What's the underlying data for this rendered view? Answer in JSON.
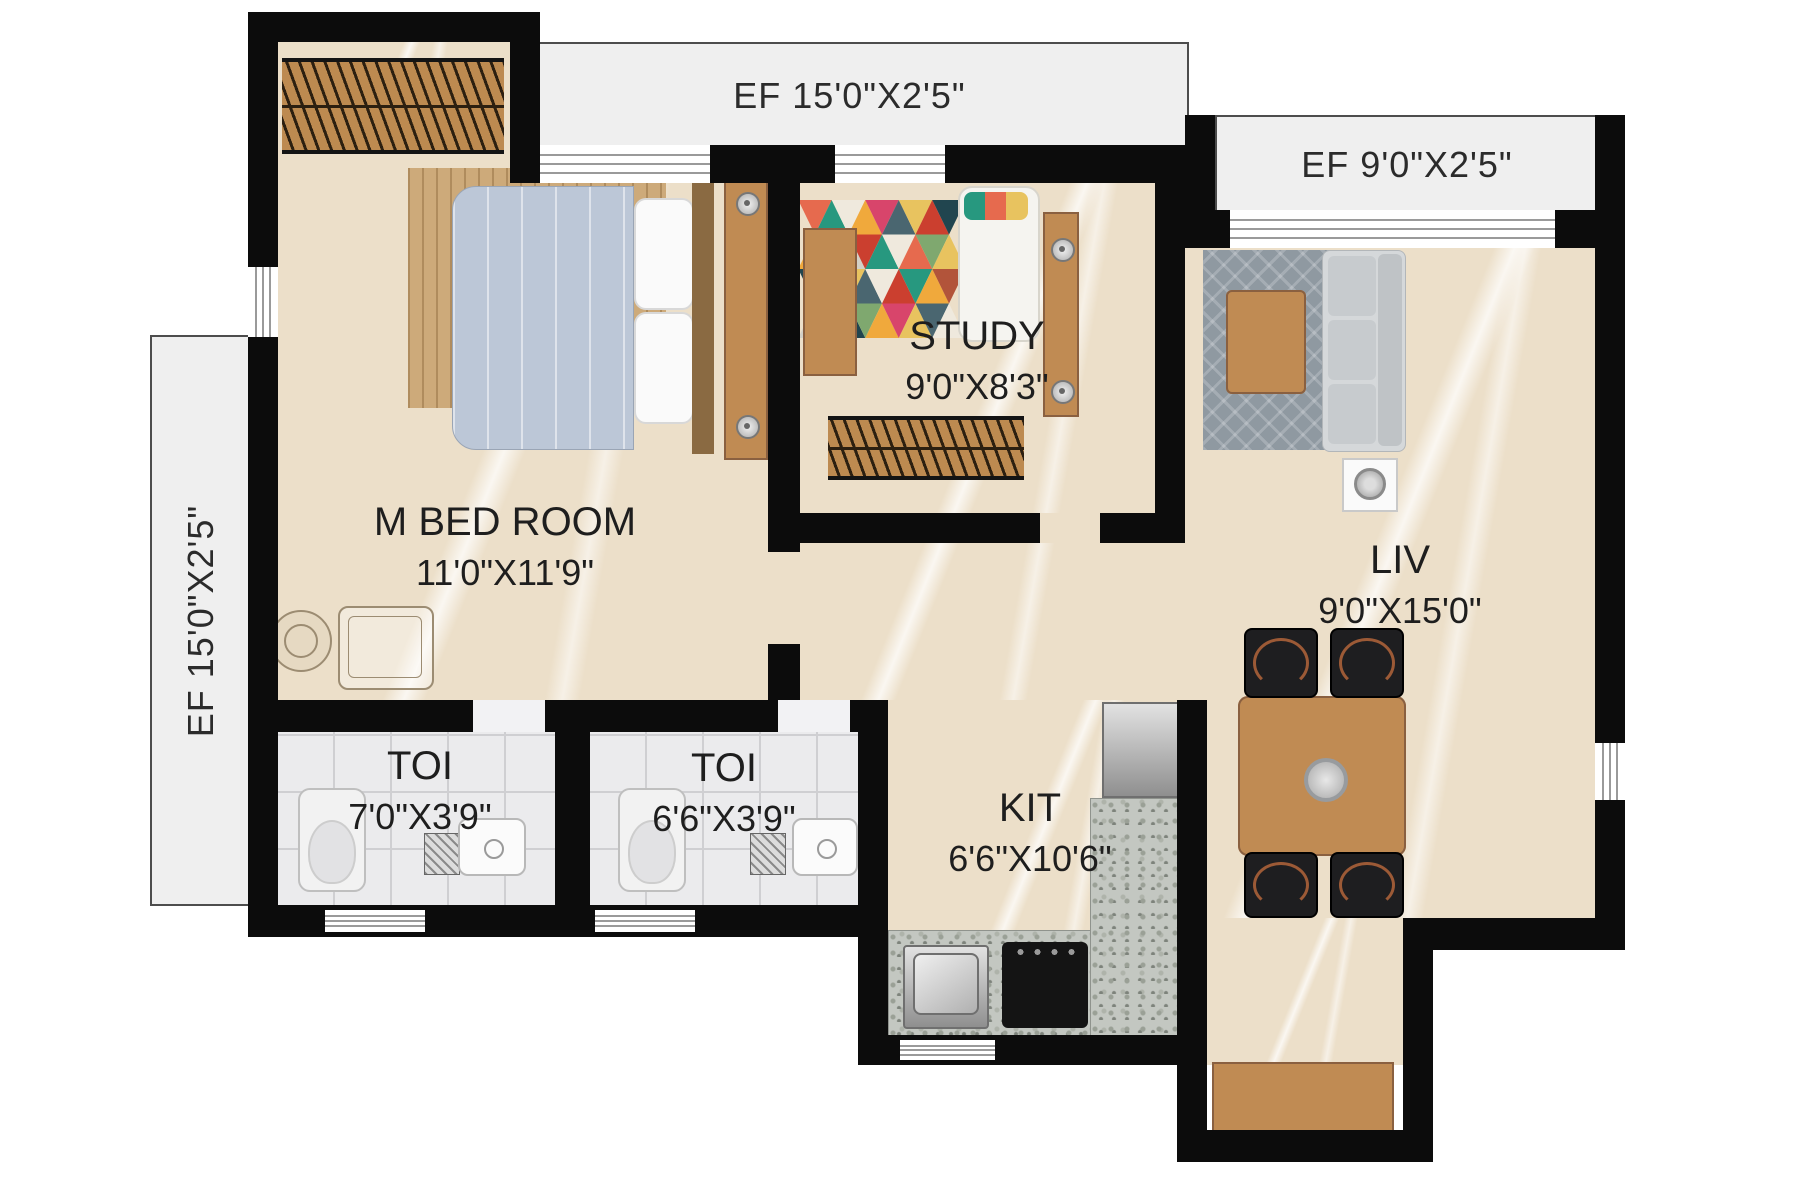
{
  "plan": {
    "title": "2BHK Floor Plan",
    "ef_top": "EF 15'0\"X2'5\"",
    "ef_right": "EF 9'0\"X2'5\"",
    "ef_left": "EF 15'0\"X2'5\"",
    "rooms": {
      "mbed": {
        "name": "M BED ROOM",
        "dim": "11'0\"X11'9\""
      },
      "study": {
        "name": "STUDY",
        "dim": "9'0\"X8'3\""
      },
      "liv": {
        "name": "LIV",
        "dim": "9'0\"X15'0\""
      },
      "toi1": {
        "name": "TOI",
        "dim": "7'0\"X3'9\""
      },
      "toi2": {
        "name": "TOI",
        "dim": "6'6\"X3'9\""
      },
      "kit": {
        "name": "KIT",
        "dim": "6'6\"X10'6\""
      }
    },
    "colors": {
      "wall": "#0c0c0c",
      "floor": "#ecdfc9",
      "tile": "#ebebed",
      "ef_bg": "#efefef",
      "wood": "#c08b53",
      "granite": "#c3c7c1"
    }
  }
}
